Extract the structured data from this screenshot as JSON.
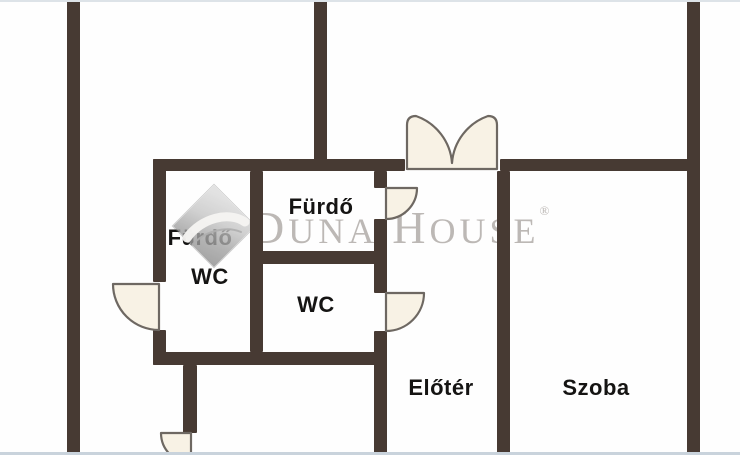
{
  "rooms": {
    "bathroom_left": {
      "label": "Fürdő"
    },
    "wc_left": {
      "label": "WC"
    },
    "bathroom_right": {
      "label": "Fürdő"
    },
    "wc_right": {
      "label": "WC"
    },
    "hall": {
      "label": "Előtér"
    },
    "room": {
      "label": "Szoba"
    }
  },
  "watermark": {
    "brand_first": "D",
    "brand_rest": "UNA",
    "brand2_first": "H",
    "brand2_rest": "OUSE",
    "registered": "®"
  },
  "colors": {
    "wall": "#473a33",
    "door-fill": "#f8f2e5",
    "door-stroke": "#6e6862",
    "watermark": "#bcb8b5",
    "label": "#151413",
    "edge-top": "#dde3e8",
    "edge-bottom": "#c9d3dc",
    "logo-light": "#dcdcdc",
    "logo-dark": "#8d8d8d"
  }
}
